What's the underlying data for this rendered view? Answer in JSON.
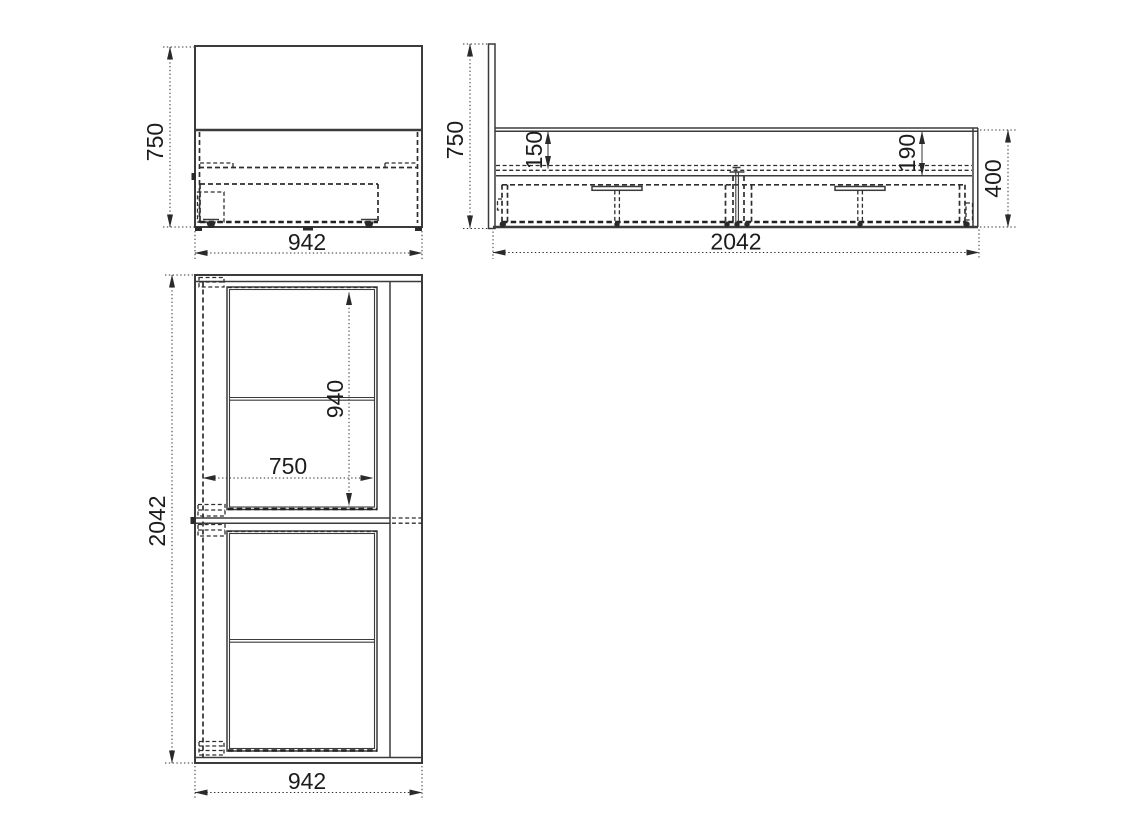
{
  "drawing": {
    "background": "#ffffff",
    "line_color": "#3b3b3b",
    "dim_color": "#1c1c1c",
    "views": {
      "front": {
        "height": "750",
        "width": "942"
      },
      "side": {
        "height": "750",
        "top_inset": "150",
        "rail_depth": "190",
        "base_height": "400",
        "length": "2042"
      },
      "plan": {
        "length": "2042",
        "drawer_length": "940",
        "drawer_width": "750",
        "width": "942"
      }
    }
  }
}
